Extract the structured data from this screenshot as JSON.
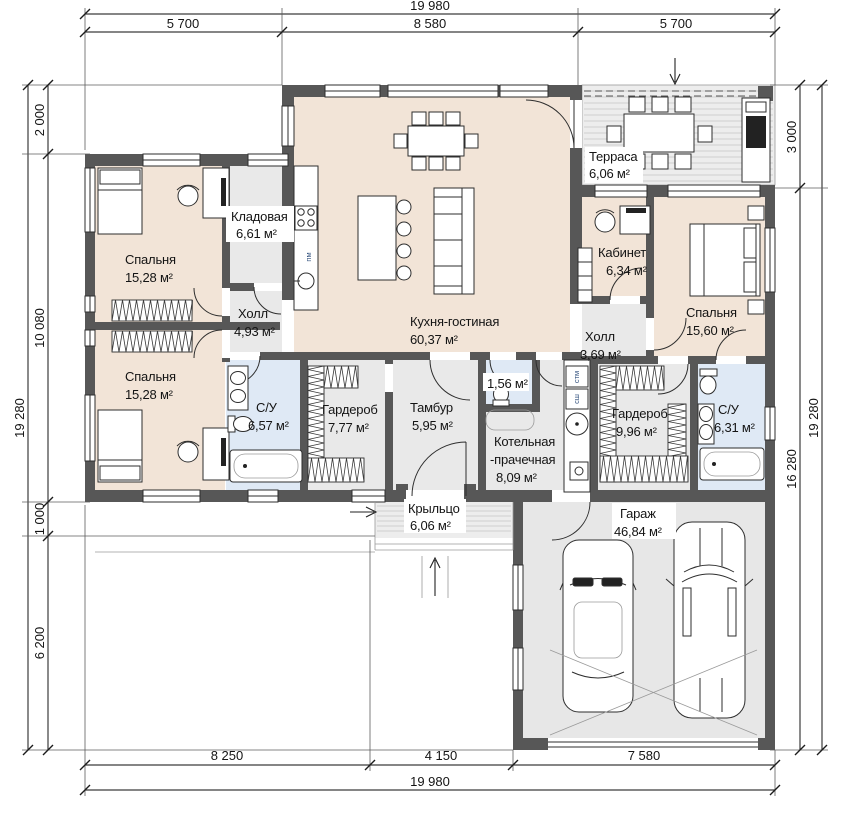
{
  "dims": {
    "top": {
      "total": "19 980",
      "seg1": "5 700",
      "seg2": "8 580",
      "seg3": "5 700"
    },
    "bottom": {
      "total": "19 980",
      "seg1": "8 250",
      "seg2": "4 150",
      "seg3": "7 580"
    },
    "left": {
      "total": "19 280",
      "seg1": "2 000",
      "seg2": "10 080",
      "seg3": "1 000",
      "seg4": "6 200"
    },
    "right": {
      "total": "19 280",
      "seg1": "3 000",
      "seg2": "16 280"
    }
  },
  "rooms": {
    "bedroom_top_left": {
      "name": "Спальня",
      "area": "15,28 м²"
    },
    "pantry": {
      "name": "Кладовая",
      "area": "6,61 м²"
    },
    "hall_left": {
      "name": "Холл",
      "area": "4,93 м²"
    },
    "kitchen_living": {
      "name": "Кухня-гостиная",
      "area": "60,37 м²"
    },
    "terrace": {
      "name": "Терраса",
      "area": "6,06 м²"
    },
    "office": {
      "name": "Кабинет",
      "area": "6,34 м²"
    },
    "bedroom_right": {
      "name": "Спальня",
      "area": "15,60 м²"
    },
    "hall_right": {
      "name": "Холл",
      "area": "3,69 м²"
    },
    "bedroom_bottom_left": {
      "name": "Спальня",
      "area": "15,28 м²"
    },
    "bathroom_left": {
      "name": "С/У",
      "area": "6,57 м²"
    },
    "wardrobe_left": {
      "name": "Гардероб",
      "area": "7,77 м²"
    },
    "vestibule": {
      "name": "Тамбур",
      "area": "5,95 м²"
    },
    "wc_small": {
      "area": "1,56 м²"
    },
    "boiler_laundry": {
      "name1": "Котельная",
      "name2": "-прачечная",
      "area": "8,09 м²"
    },
    "wardrobe_right": {
      "name": "Гардероб",
      "area": "9,96 м²"
    },
    "bathroom_right": {
      "name": "С/У",
      "area": "6,31 м²"
    },
    "porch": {
      "name": "Крыльцо",
      "area": "6,06 м²"
    },
    "garage": {
      "name": "Гараж",
      "area": "46,84 м²"
    }
  },
  "appliances": {
    "dishwasher": "пм",
    "washer": "стм",
    "dryer": "сш"
  },
  "colors": {
    "wall": "#575757",
    "floor_beige": "#f2e4d7",
    "floor_gray": "#e9e9e9",
    "floor_blue": "#dfe9f5",
    "deck": "#ededed",
    "garage_floor": "#e7e7e7"
  }
}
